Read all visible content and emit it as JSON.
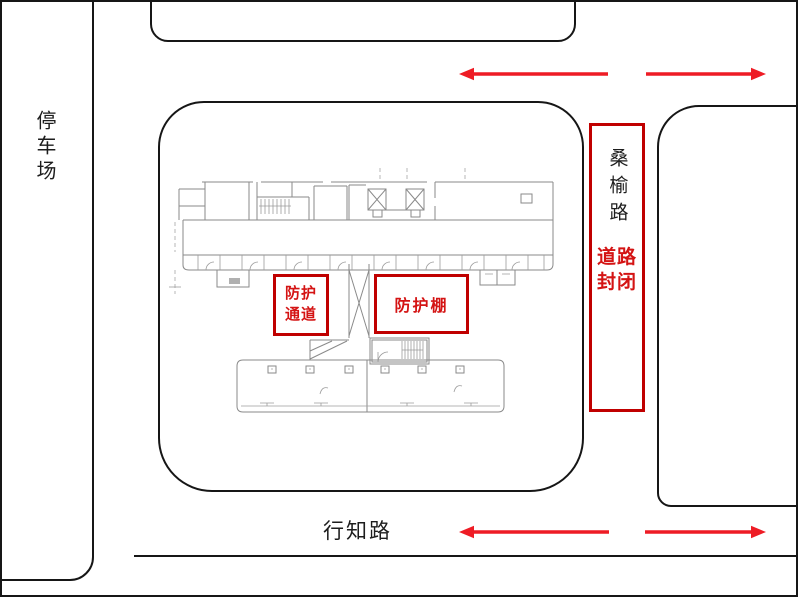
{
  "colors": {
    "frame": "#161616",
    "plan": "#8a8a8a",
    "red_box": "#c00000",
    "red_text": "#d41414",
    "arrow": "#ee1c25"
  },
  "labels": {
    "parking": "停车场",
    "sangyu_road": "桑榆路",
    "road_closed_line1": "道路",
    "road_closed_line2": "封闭",
    "protect_channel_line1": "防护",
    "protect_channel_line2": "通道",
    "protect_shed": "防护棚",
    "xingzhi_road": "行知路"
  }
}
